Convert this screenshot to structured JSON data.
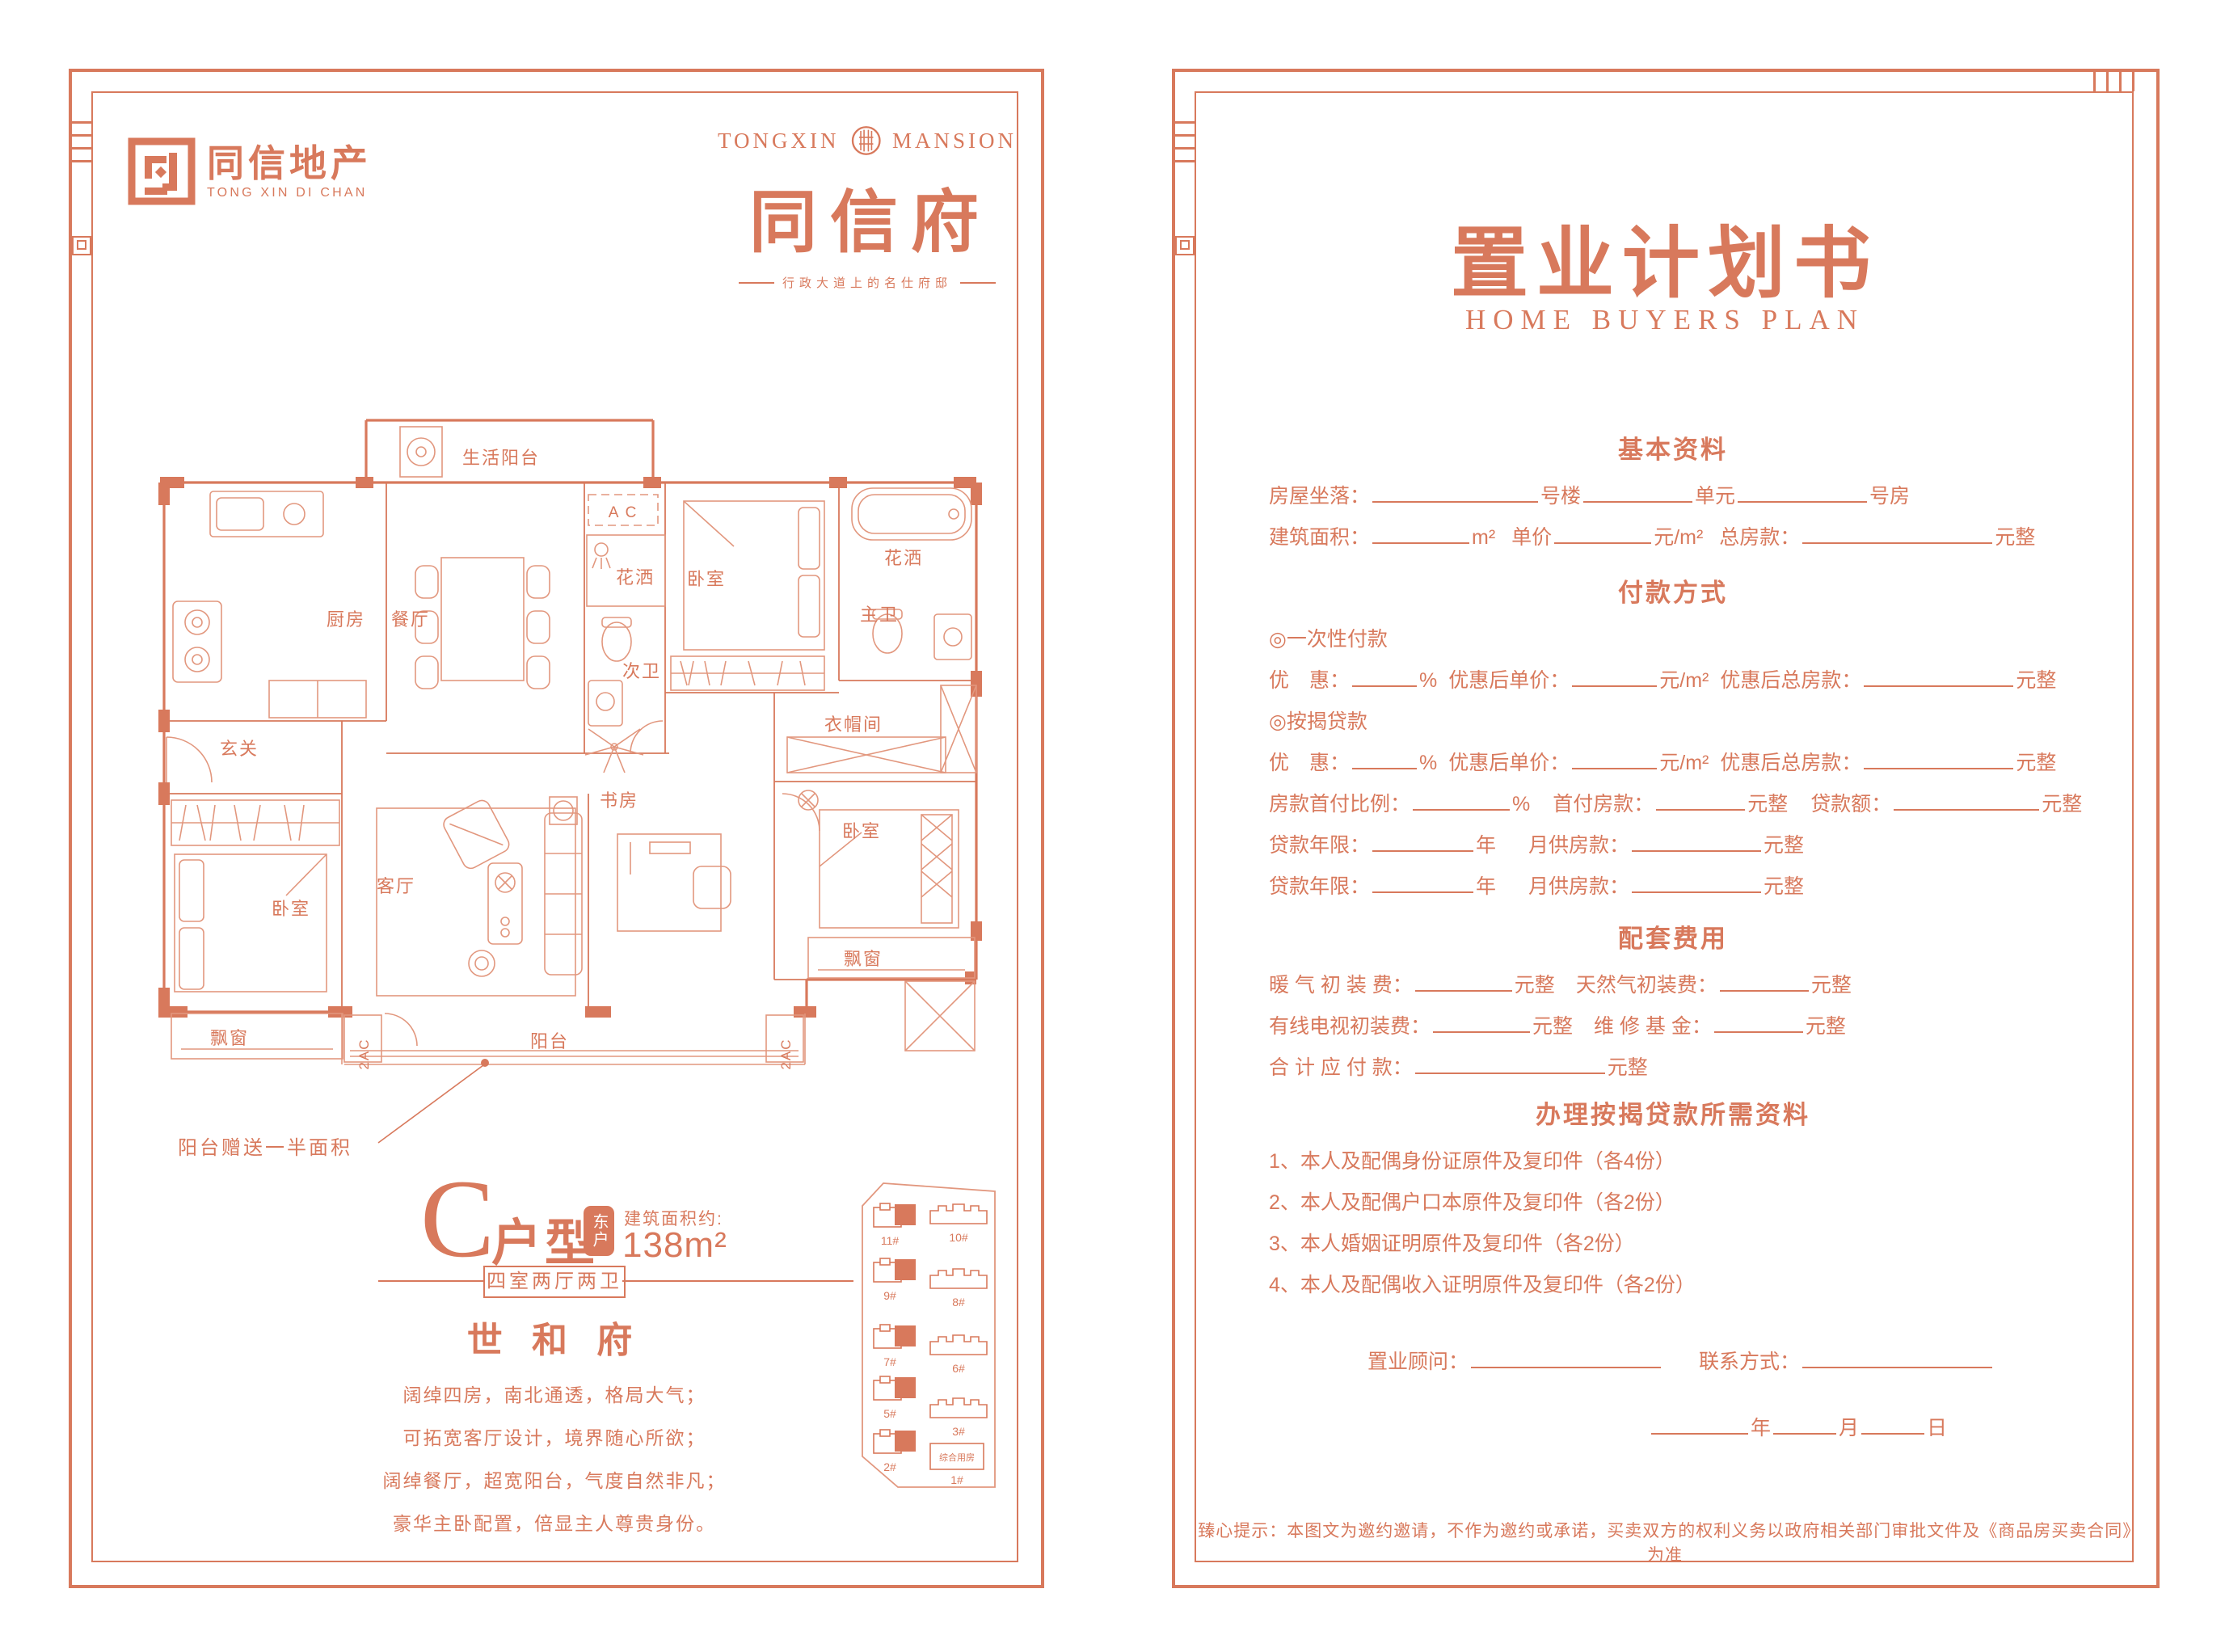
{
  "accent_color": "#D8795C",
  "brand": {
    "logo_cn": "同信地产",
    "logo_en": "TONG XIN DI CHAN"
  },
  "mansion": {
    "en_left": "TONGXIN",
    "en_right": "MANSION",
    "cn": "同信府",
    "slogan": "行政大道上的名仕府邸"
  },
  "floorplan": {
    "rooms": {
      "service_balcony": "生活阳台",
      "kitchen": "厨房",
      "dining": "餐厅",
      "ac": "A C",
      "ac2": "2AC",
      "shower": "花洒",
      "bedroom": "卧室",
      "bathroom2": "次卫",
      "master_bath": "主卫",
      "foyer": "玄关",
      "cloakroom": "衣帽间",
      "living": "客厅",
      "study": "书房",
      "bay_window": "飘窗",
      "balcony": "阳台"
    },
    "callout": "阳台赠送一半面积"
  },
  "unit": {
    "letter": "C",
    "suffix": "户型",
    "badge": "东户",
    "area_label": "建筑面积约:",
    "area_value": "138m²",
    "tag": "四室两厅两卫",
    "name": "世 和 府",
    "desc": [
      "阔绰四房，南北通透，格局大气；",
      "可拓宽客厅设计，境界随心所欲；",
      "阔绰餐厅，超宽阳台，气度自然非凡；",
      "豪华主卧配置，倍显主人尊贵身份。"
    ]
  },
  "sitemap": {
    "left_labels": [
      "11#",
      "9#",
      "7#",
      "5#",
      "2#"
    ],
    "right_labels": [
      "10#",
      "8#",
      "6#",
      "3#"
    ],
    "annex": "综合用房",
    "annex_num": "1#"
  },
  "plan_doc": {
    "title": "置业计划书",
    "subtitle": "HOME BUYERS PLAN",
    "sections": [
      {
        "heading": "基本资料",
        "rows": [
          [
            {
              "t": "房屋坐落："
            },
            {
              "b": 205
            },
            {
              "t": "号楼"
            },
            {
              "b": 135
            },
            {
              "t": "单元"
            },
            {
              "b": 160
            },
            {
              "t": "号房"
            }
          ],
          [
            {
              "t": "建筑面积："
            },
            {
              "b": 120
            },
            {
              "t": "m²"
            },
            {
              "g": 20
            },
            {
              "t": "单价"
            },
            {
              "b": 120
            },
            {
              "t": "元/m²"
            },
            {
              "g": 20
            },
            {
              "t": "总房款："
            },
            {
              "b": 235
            },
            {
              "t": "元整"
            }
          ]
        ]
      },
      {
        "heading": "付款方式",
        "rows": [
          [
            {
              "t": "◎一次性付款"
            }
          ],
          [
            {
              "t": "优　惠："
            },
            {
              "b": 80
            },
            {
              "t": "%"
            },
            {
              "g": 14
            },
            {
              "t": "优惠后单价："
            },
            {
              "b": 105
            },
            {
              "t": "元/m²"
            },
            {
              "g": 14
            },
            {
              "t": "优惠后总房款："
            },
            {
              "b": 185
            },
            {
              "t": "元整"
            }
          ],
          [
            {
              "t": "◎按揭贷款"
            }
          ],
          [
            {
              "t": "优　惠："
            },
            {
              "b": 80
            },
            {
              "t": "%"
            },
            {
              "g": 14
            },
            {
              "t": "优惠后单价："
            },
            {
              "b": 105
            },
            {
              "t": "元/m²"
            },
            {
              "g": 14
            },
            {
              "t": "优惠后总房款："
            },
            {
              "b": 185
            },
            {
              "t": "元整"
            }
          ],
          [
            {
              "t": "房款首付比例："
            },
            {
              "b": 120
            },
            {
              "t": "%"
            },
            {
              "g": 28
            },
            {
              "t": "首付房款："
            },
            {
              "b": 110
            },
            {
              "t": "元整"
            },
            {
              "g": 28
            },
            {
              "t": "贷款额："
            },
            {
              "b": 180
            },
            {
              "t": "元整"
            }
          ],
          [
            {
              "t": "贷款年限："
            },
            {
              "b": 125
            },
            {
              "t": "年"
            },
            {
              "g": 40
            },
            {
              "t": "月供房款："
            },
            {
              "b": 160
            },
            {
              "t": "元整"
            }
          ],
          [
            {
              "t": "贷款年限："
            },
            {
              "b": 125
            },
            {
              "t": "年"
            },
            {
              "g": 40
            },
            {
              "t": "月供房款："
            },
            {
              "b": 160
            },
            {
              "t": "元整"
            }
          ]
        ]
      },
      {
        "heading": "配套费用",
        "rows": [
          [
            {
              "t": "暖 气 初 装 费："
            },
            {
              "b": 120
            },
            {
              "t": "元整"
            },
            {
              "g": 26
            },
            {
              "t": "天然气初装费："
            },
            {
              "b": 110
            },
            {
              "t": "元整"
            }
          ],
          [
            {
              "t": "有线电视初装费："
            },
            {
              "b": 120
            },
            {
              "t": "元整"
            },
            {
              "g": 26
            },
            {
              "t": "维 修 基 金："
            },
            {
              "b": 110
            },
            {
              "t": "元整"
            }
          ],
          [
            {
              "t": "合 计 应 付 款："
            },
            {
              "b": 235
            },
            {
              "t": "元整"
            }
          ]
        ]
      },
      {
        "heading": "办理按揭贷款所需资料",
        "rows": [
          [
            {
              "t": "1、本人及配偶身份证原件及复印件（各4份）"
            }
          ],
          [
            {
              "t": "2、本人及配偶户口本原件及复印件（各2份）"
            }
          ],
          [
            {
              "t": "3、本人婚姻证明原件及复印件（各2份）"
            }
          ],
          [
            {
              "t": "4、本人及配偶收入证明原件及复印件（各2份）"
            }
          ]
        ]
      }
    ],
    "consultant_row": [
      {
        "t": "置业顾问："
      },
      {
        "b": 235
      },
      {
        "g": 44
      },
      {
        "t": "联系方式："
      },
      {
        "b": 235
      }
    ],
    "date_row": [
      {
        "b": 120
      },
      {
        "t": "年"
      },
      {
        "b": 78
      },
      {
        "t": "月"
      },
      {
        "b": 78
      },
      {
        "t": "日"
      }
    ],
    "disclaimer": "臻心提示：本图文为邀约邀请，不作为邀约或承诺，买卖双方的权利义务以政府相关部门审批文件及《商品房买卖合同》为准"
  }
}
